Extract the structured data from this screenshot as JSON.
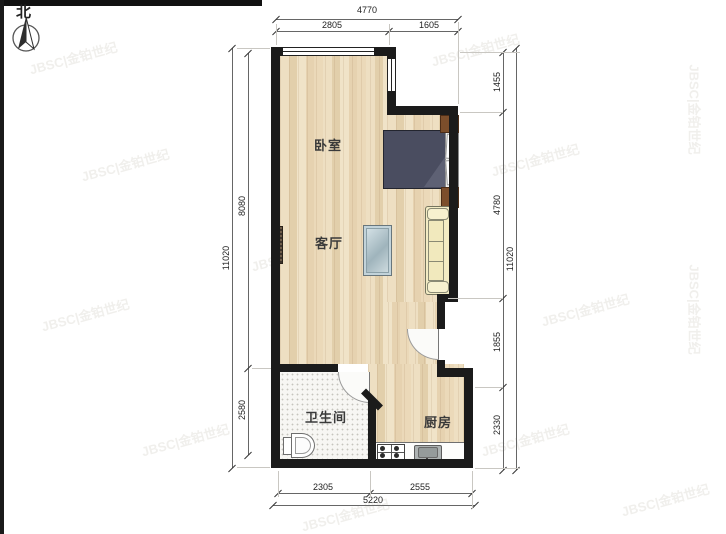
{
  "north": {
    "label": "北"
  },
  "rooms": {
    "bedroom": {
      "label": "卧室"
    },
    "living": {
      "label": "客厅"
    },
    "bathroom": {
      "label": "卫生间"
    },
    "kitchen": {
      "label": "厨房"
    }
  },
  "dimensions": {
    "top": {
      "overall": "4770",
      "segments": [
        "2805",
        "1605"
      ]
    },
    "left": {
      "overall": "11020",
      "segments": [
        "8080",
        "2580"
      ]
    },
    "right": {
      "overall": "11020",
      "segments": [
        "1455",
        "4780",
        "1855",
        "2330"
      ]
    },
    "bottom": {
      "overall": "5220",
      "segments": [
        "2305",
        "2555"
      ]
    }
  },
  "watermark": {
    "text": "JBSC|金铂世纪"
  },
  "furniture": {
    "bed": "double-bed",
    "sofa": "sofa",
    "table": "coffee-table",
    "stove": "gas-stove",
    "sink": "kitchen-sink",
    "toilet": "toilet",
    "wardrobe": "cabinet",
    "radiator": "radiator"
  },
  "colors": {
    "wall": "#1b1b1b",
    "floor": "#ebd9b9",
    "tile": "#f7f6f3",
    "bed": "#4a4d60",
    "sofa": "#f3ecc4",
    "cabinet": "#7c4e2b",
    "table": "#bfd0d8",
    "dimension_line": "#666666",
    "text": "#333333"
  }
}
